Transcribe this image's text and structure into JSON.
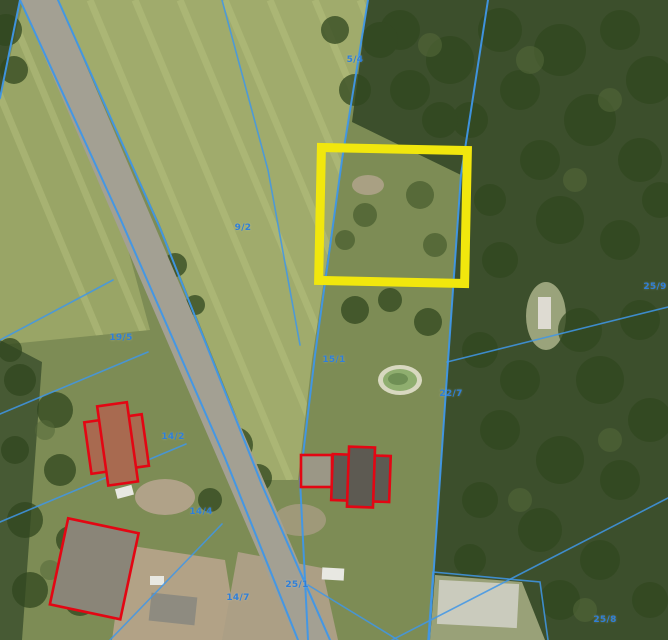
{
  "map": {
    "type": "cadastral-aerial-orthophoto",
    "description": "Aerial photo with cadastral parcel boundaries, one parcel highlighted in yellow, buildings outlined in red",
    "colors": {
      "parcel_line": "#3f97e8",
      "label_blue": "#2f7fd8",
      "highlight": "#f1e70d",
      "building_outline": "#e30613"
    },
    "parcel_labels": [
      {
        "text": "5/4",
        "x": 355,
        "y": 60
      },
      {
        "text": "9/2",
        "x": 243,
        "y": 228
      },
      {
        "text": "19/5",
        "x": 121,
        "y": 338
      },
      {
        "text": "14/2",
        "x": 173,
        "y": 437
      },
      {
        "text": "14/4",
        "x": 201,
        "y": 512
      },
      {
        "text": "14/7",
        "x": 238,
        "y": 598
      },
      {
        "text": "15/1",
        "x": 334,
        "y": 360
      },
      {
        "text": "22/7",
        "x": 451,
        "y": 394
      },
      {
        "text": "25/9",
        "x": 655,
        "y": 287
      },
      {
        "text": "25/1",
        "x": 297,
        "y": 585
      },
      {
        "text": "25/8",
        "x": 605,
        "y": 620
      }
    ],
    "features": [
      "road",
      "forest",
      "mown-field",
      "pond",
      "highlighted-parcel",
      "red-outlined-buildings",
      "greenhouse",
      "vehicles"
    ]
  }
}
